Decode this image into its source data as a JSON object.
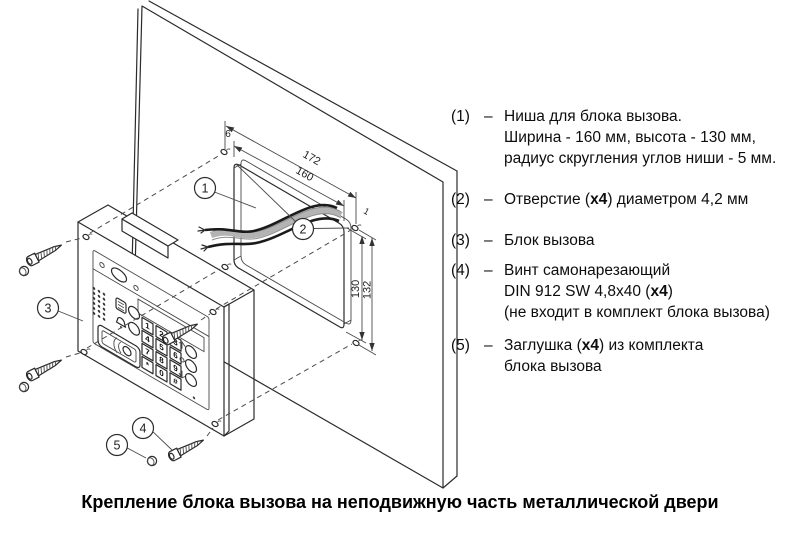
{
  "drawing": {
    "dims": {
      "top_outer": "172",
      "top_inner": "160",
      "top_left_offset": "6",
      "top_right_offset": "1",
      "right_inner": "130",
      "right_outer": "132"
    },
    "callouts": [
      "1",
      "2",
      "3",
      "4",
      "5"
    ],
    "keypad": [
      "1",
      "2",
      "3",
      "4",
      "5",
      "6",
      "7",
      "8",
      "9",
      "*",
      "0",
      "#"
    ]
  },
  "legend": {
    "items": [
      {
        "num": "(1)",
        "dash": "–",
        "lines": [
          [
            {
              "t": "Ниша для блока вызова."
            }
          ],
          [
            {
              "t": "Ширина - 160 мм, высота - 130 мм,"
            }
          ],
          [
            {
              "t": "радиус скругления углов ниши - 5 мм."
            }
          ]
        ]
      },
      {
        "num": "(2)",
        "dash": "–",
        "lines": [
          [
            {
              "t": "Отверстие ("
            },
            {
              "t": "x4",
              "b": true
            },
            {
              "t": ") диаметром 4,2 мм"
            }
          ]
        ]
      },
      {
        "num": "(3)",
        "dash": "–",
        "lines": [
          [
            {
              "t": "Блок вызова"
            }
          ]
        ]
      },
      {
        "num": "(4)",
        "dash": "–",
        "lines": [
          [
            {
              "t": "Винт самонарезающий"
            }
          ],
          [
            {
              "t": "DIN 912 SW  4,8x40 ("
            },
            {
              "t": "x4",
              "b": true
            },
            {
              "t": ")"
            }
          ],
          [
            {
              "t": "(не входит в комплект блока вызова)"
            }
          ]
        ]
      },
      {
        "num": "(5)",
        "dash": "–",
        "lines": [
          [
            {
              "t": "Заглушка ("
            },
            {
              "t": "x4",
              "b": true
            },
            {
              "t": ") из комплекта"
            }
          ],
          [
            {
              "t": "блока вызова"
            }
          ]
        ]
      }
    ]
  },
  "caption": "Крепление блока вызова на неподвижную часть металлической двери",
  "colors": {
    "line": "#2b2b2b",
    "wire": "#1a1a1a",
    "bundle": "#b3b3b3",
    "background": "#ffffff"
  }
}
